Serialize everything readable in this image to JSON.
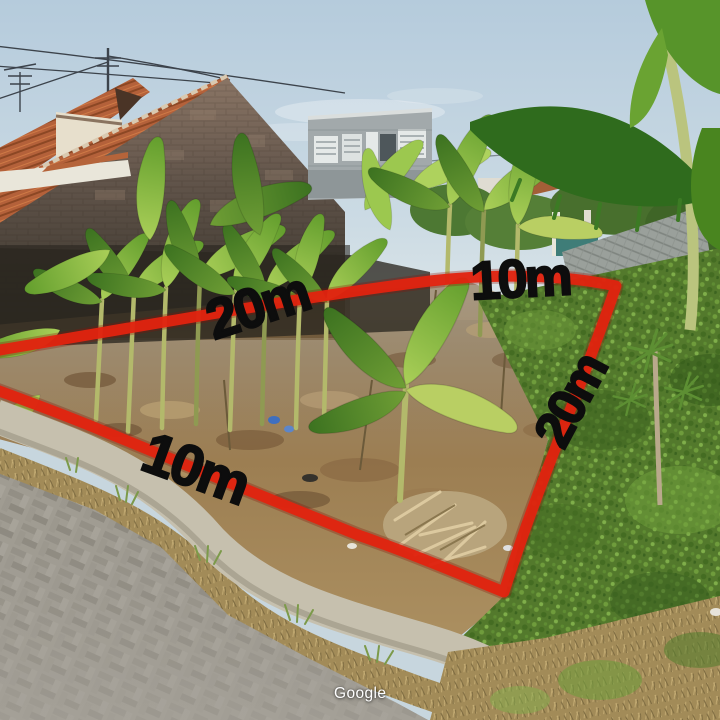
{
  "watermark": {
    "text": "Google"
  },
  "annotations": {
    "boundary_color": "#e2230f",
    "label_text_color": "#0d0d0d",
    "measurements": {
      "back_width": "10m",
      "left_side": "20m",
      "right_side": "20m",
      "front_width": "10m"
    }
  }
}
